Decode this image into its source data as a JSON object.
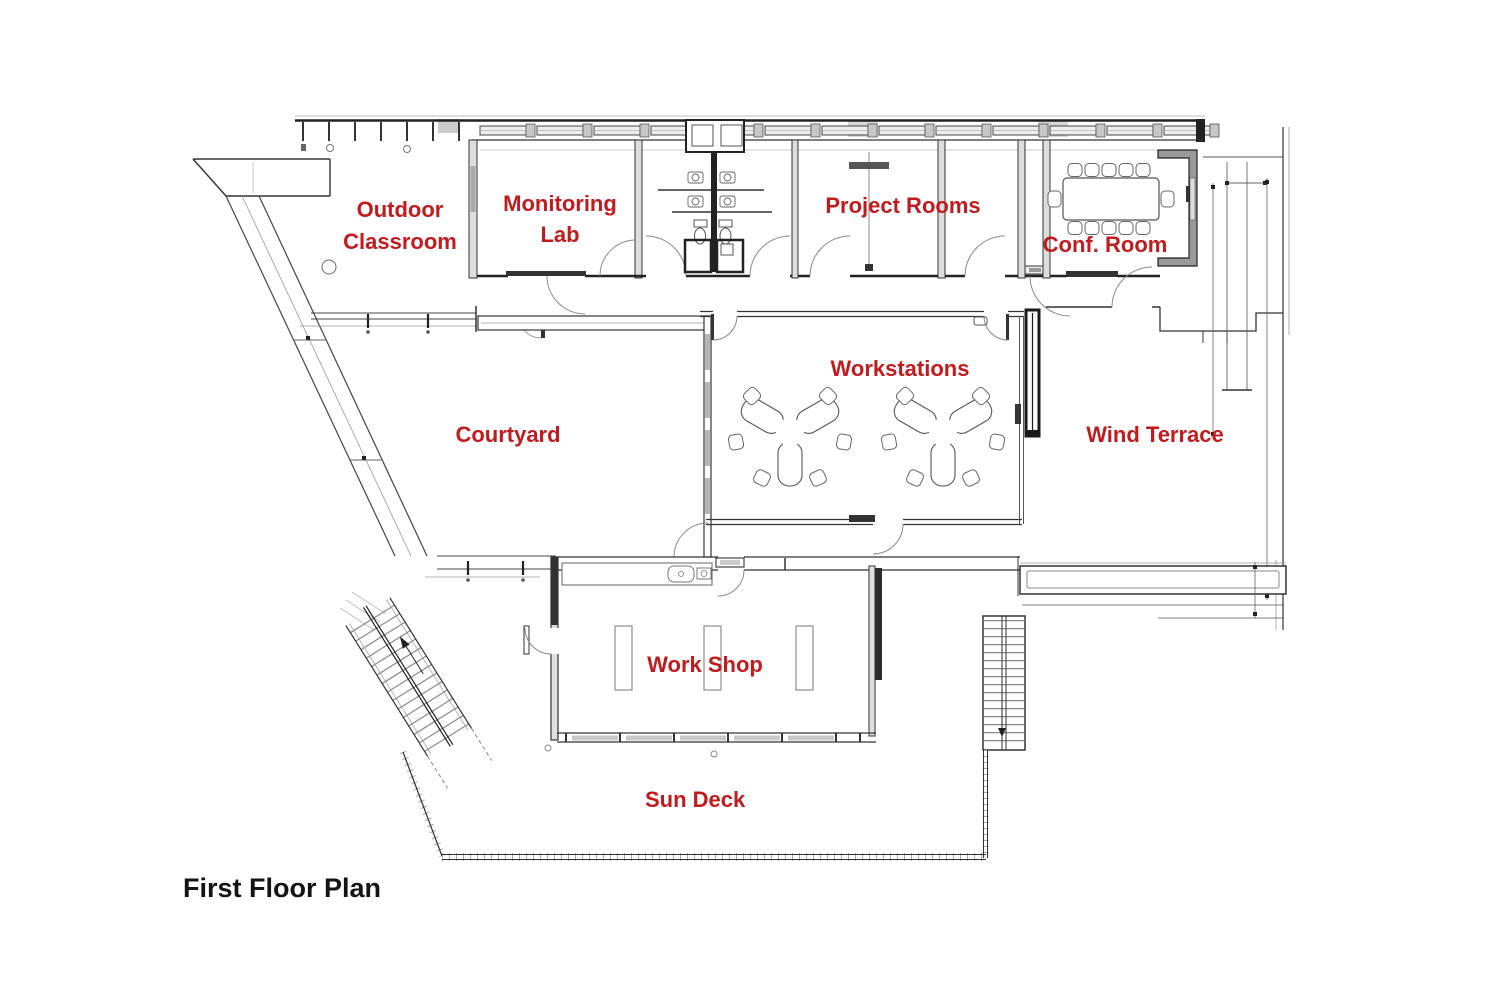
{
  "plan": {
    "title": "First Floor Plan",
    "label_color": "#c01b1e",
    "title_color": "#141414",
    "line_color": "#2b2b2b",
    "rooms": {
      "outdoor_classroom": "Outdoor Classroom",
      "monitoring_lab": "Monitoring Lab",
      "project_rooms": "Project Rooms",
      "conf_room": "Conf. Room",
      "workstations": "Workstations",
      "courtyard": "Courtyard",
      "wind_terrace": "Wind Terrace",
      "work_shop": "Work Shop",
      "sun_deck": "Sun Deck"
    }
  }
}
